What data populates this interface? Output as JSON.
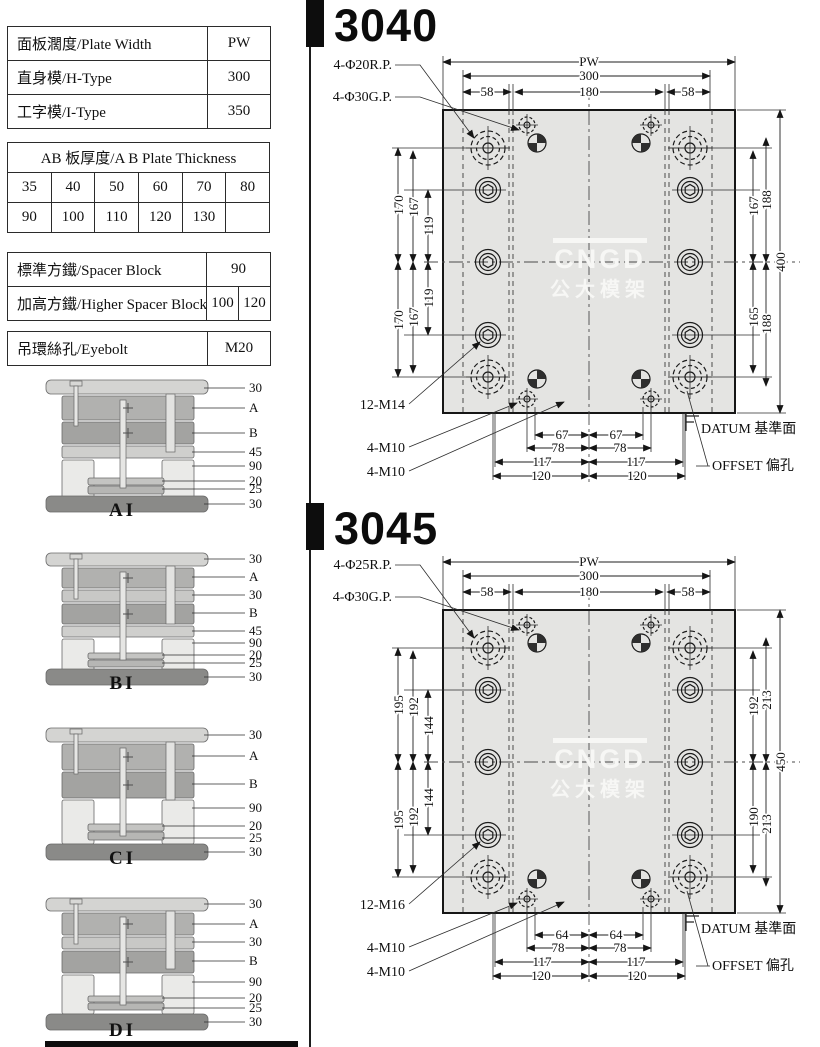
{
  "spec_table": {
    "rows": [
      {
        "label": "面板濶度/Plate Width",
        "value": "PW"
      },
      {
        "label": "直身模/H-Type",
        "value": "300"
      },
      {
        "label": "工字模/I-Type",
        "value": "350"
      }
    ]
  },
  "thickness_table": {
    "title": "AB 板厚度/A B Plate Thickness",
    "rows": [
      [
        "35",
        "40",
        "50",
        "60",
        "70",
        "80"
      ],
      [
        "90",
        "100",
        "110",
        "120",
        "130",
        ""
      ]
    ]
  },
  "spacer_table": {
    "rows": [
      {
        "label": "標準方鐵/Spacer Block",
        "values": [
          "90"
        ]
      },
      {
        "label": "加高方鐵/Higher Spacer Block",
        "values": [
          "100",
          "120"
        ]
      }
    ]
  },
  "eyebolt_table": {
    "label": "吊環絲孔/Eyebolt",
    "value": "M20"
  },
  "molds": [
    {
      "name": "AI",
      "labels": [
        "30",
        "A",
        "B",
        "45",
        "90",
        "20",
        "25",
        "30"
      ]
    },
    {
      "name": "BI",
      "labels": [
        "30",
        "A",
        "30",
        "B",
        "45",
        "90",
        "20",
        "25",
        "30"
      ]
    },
    {
      "name": "CI",
      "labels": [
        "30",
        "A",
        "B",
        "90",
        "20",
        "25",
        "30"
      ]
    },
    {
      "name": "DI",
      "labels": [
        "30",
        "A",
        "30",
        "B",
        "90",
        "20",
        "25",
        "30"
      ]
    }
  ],
  "drawings": [
    {
      "model": "3040",
      "callouts": {
        "rp": "4-Φ20R.P.",
        "gp": "4-Φ30G.P.",
        "screws": "12-M14",
        "m10_upper": "4-M10",
        "m10_lower": "4-M10",
        "datum": "DATUM 基準面",
        "offset": "OFFSET 偏孔"
      },
      "dims": {
        "top": [
          "PW",
          "300",
          "58",
          "180",
          "58"
        ],
        "left": [
          "170",
          "167",
          "119",
          "119",
          "167",
          "170"
        ],
        "right": [
          "167",
          "188",
          "165",
          "188",
          "400"
        ],
        "bottom": [
          "67",
          "78",
          "117",
          "120"
        ]
      },
      "watermark": {
        "line1": "CNGD",
        "line2": "公大模架"
      }
    },
    {
      "model": "3045",
      "callouts": {
        "rp": "4-Φ25R.P.",
        "gp": "4-Φ30G.P.",
        "screws": "12-M16",
        "m10_upper": "4-M10",
        "m10_lower": "4-M10",
        "datum": "DATUM 基準面",
        "offset": "OFFSET 偏孔"
      },
      "dims": {
        "top": [
          "PW",
          "300",
          "58",
          "180",
          "58"
        ],
        "left": [
          "195",
          "192",
          "144",
          "144",
          "192",
          "195"
        ],
        "right": [
          "192",
          "213",
          "190",
          "213",
          "450"
        ],
        "bottom": [
          "64",
          "78",
          "117",
          "120"
        ]
      },
      "watermark": {
        "line1": "CNGD",
        "line2": "公大模架"
      }
    }
  ]
}
